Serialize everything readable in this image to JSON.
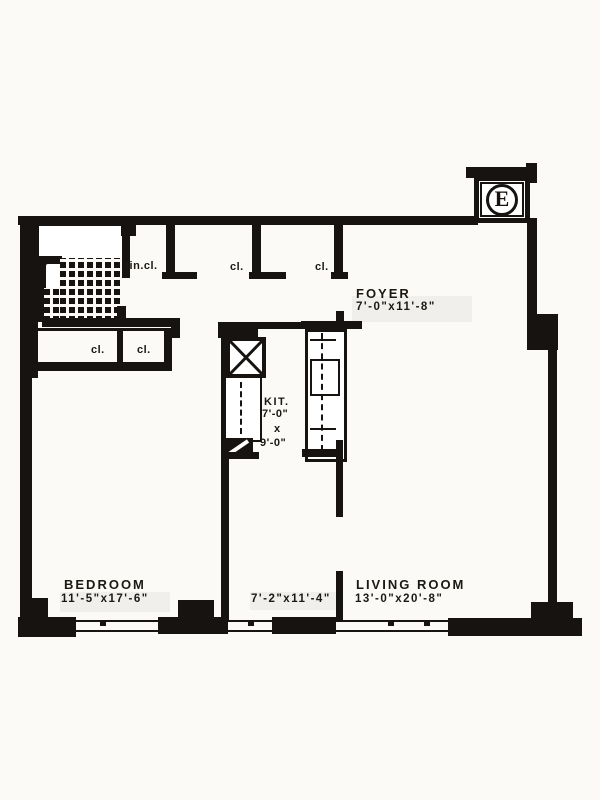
{
  "style": {
    "ink": "#161310",
    "paper": "#fbfaf7"
  },
  "plan": {
    "marker": {
      "letter": "E"
    },
    "rooms": {
      "foyer": {
        "name": "FOYER",
        "dims": "7'-0\"x11'-8\""
      },
      "kitchen": {
        "name": "KIT.",
        "dim_w": "7'-0\"",
        "dim_sep": "x",
        "dim_h": "9'-0\""
      },
      "bedroom": {
        "name": "BEDROOM",
        "dims": "11'-5\"x17'-6\""
      },
      "dining": {
        "dims": "7'-2\"x11'-4\""
      },
      "living": {
        "name": "LIVING ROOM",
        "dims": "13'-0\"x20'-8\""
      }
    },
    "closets": {
      "linen": "lin.cl.",
      "hall_closet_1": "cl.",
      "hall_closet_2": "cl.",
      "bedroom_closet_1": "cl.",
      "bedroom_closet_2": "cl."
    }
  }
}
